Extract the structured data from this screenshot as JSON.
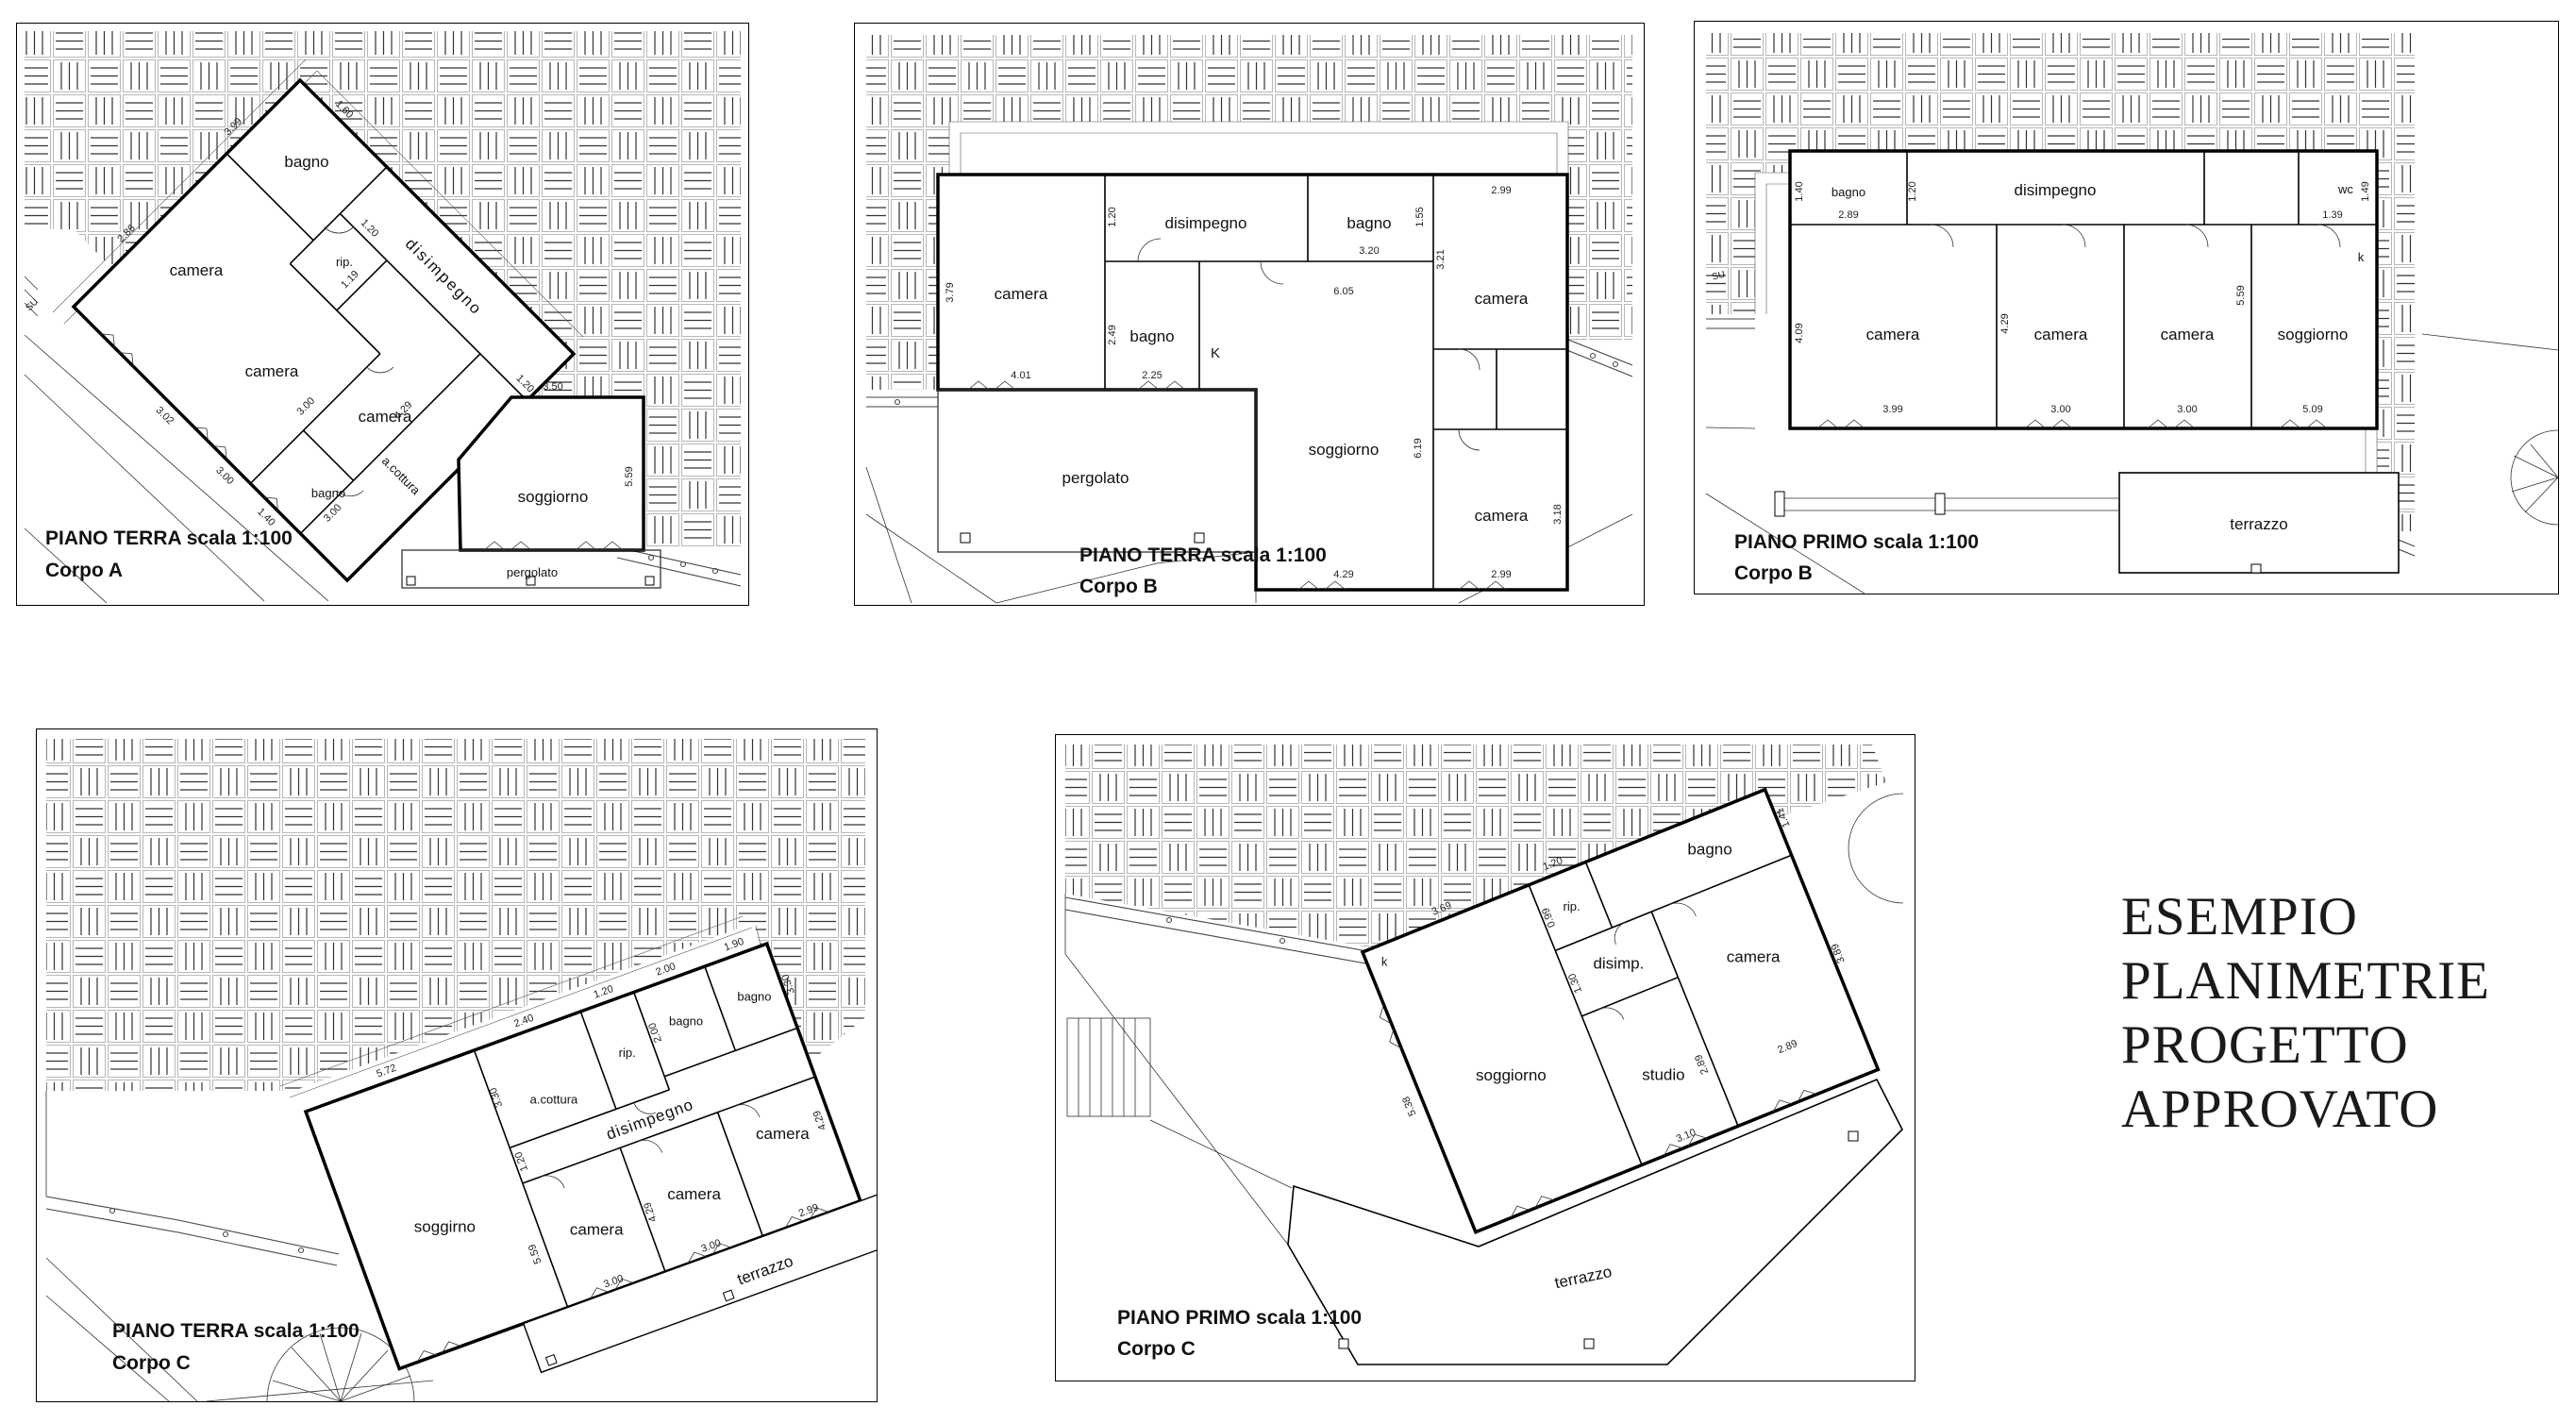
{
  "side_text": {
    "line1": "ESEMPIO",
    "line2": "PLANIMETRIE",
    "line3": "PROGETTO",
    "line4": "APPROVATO"
  },
  "plans": {
    "a_terra": {
      "caption1": "PIANO TERRA scala 1:100",
      "caption2": "Corpo A",
      "rooms": {
        "bagno1": "bagno",
        "camera1": "camera",
        "disimpegno": "disimpegno",
        "rip": "rip.",
        "camera2": "camera",
        "camera3": "camera",
        "bagno2": "bagno",
        "acottura": "a.cottura",
        "soggiorno": "soggiorno",
        "pergolato": "pergolato"
      },
      "labels": {
        "su": "SU"
      },
      "dims": {
        "top_1": "1.60",
        "nw_1": "3.99",
        "nw_2": "2.86",
        "rip_top": "1.20",
        "rip_side": "1.19",
        "sw_1": "3.02",
        "sw_2": "3.00",
        "sw_3": "1.40",
        "inner_1": "3.00",
        "inner_2": "4.29",
        "inner_3": "3.00",
        "dis_end": "1.20",
        "sog_top": "3.50",
        "sog_side": "5.59"
      }
    },
    "b_terra": {
      "caption1": "PIANO TERRA scala 1:100",
      "caption2": "Corpo B",
      "rooms": {
        "camera1": "camera",
        "disimpegno": "disimpegno",
        "bagno1": "bagno",
        "bagno2": "bagno",
        "camera2": "camera",
        "soggiorno": "soggiorno",
        "camera3": "camera",
        "pergolato": "pergolato"
      },
      "labels": {
        "k": "K"
      },
      "dims": {
        "c1_side": "3.79",
        "c1_w": "4.01",
        "dis_side": "1.20",
        "b1_side": "2.49",
        "b1_w": "2.25",
        "b2_w": "3.20",
        "b2_side": "1.55",
        "c2_w": "2.99",
        "c2_side": "3.21",
        "sog_top": "6.05",
        "sog_side": "6.19",
        "sog_w": "4.29",
        "c3_w": "2.99",
        "c3_side": "3.18"
      }
    },
    "b_primo": {
      "caption1": "PIANO PRIMO scala 1:100",
      "caption2": "Corpo B",
      "rooms": {
        "bagno": "bagno",
        "disimpegno": "disimpegno",
        "wc": "wc",
        "camera1": "camera",
        "camera2": "camera",
        "camera3": "camera",
        "soggiorno": "soggiorno",
        "terrazzo": "terrazzo"
      },
      "labels": {
        "k": "k",
        "su": "SU"
      },
      "dims": {
        "b_side": "1.40",
        "b_w": "2.89",
        "dis_side": "1.20",
        "wc_w": "1.39",
        "wc_side": "1.49",
        "c1_side": "4.09",
        "c1_w": "3.99",
        "c2_side": "4.29",
        "c2_w": "3.00",
        "c3_w": "3.00",
        "sog_side": "5.59",
        "sog_w": "5.09"
      }
    },
    "c_terra": {
      "caption1": "PIANO TERRA scala 1:100",
      "caption2": "Corpo C",
      "rooms": {
        "acottura": "a.cottura",
        "rip": "rip.",
        "bagno1": "bagno",
        "bagno2": "bagno",
        "disimpegno": "disimpegno",
        "soggirno": "soggirno",
        "camera1": "camera",
        "camera2": "camera",
        "camera3": "camera",
        "terrazzo": "terrazzo"
      },
      "dims": {
        "ac_w": "2.40",
        "ac_side": "3.30",
        "rip_w": "1.20",
        "b1_w": "2.00",
        "b1_side": "2.00",
        "b2_w": "1.90",
        "b2_side": "3.30",
        "dis_side": "1.20",
        "sog_top": "5.72",
        "sog_side": "5.59",
        "c1_w": "3.00",
        "c2_side": "4.29",
        "c2_w": "3.00",
        "c3_w": "2.99",
        "c3_side": "4.29"
      }
    },
    "c_primo": {
      "caption1": "PIANO PRIMO scala 1:100",
      "caption2": "Corpo C",
      "rooms": {
        "rip": "rip.",
        "disimp": "disimp.",
        "bagno": "bagno",
        "camera": "camera",
        "soggiorno": "soggiorno",
        "studio": "studio",
        "terrazzo": "terrazzo"
      },
      "labels": {
        "k": "k"
      },
      "dims": {
        "sog_top": "3.69",
        "sog_side": "5.38",
        "rip_w": "1.20",
        "rip_side": "0.99",
        "dis_side": "1.30",
        "b_side": "1.41",
        "cam_side": "3.89",
        "cam_w": "2.89",
        "studio_side": "2.89",
        "studio_w": "3.10"
      }
    }
  }
}
